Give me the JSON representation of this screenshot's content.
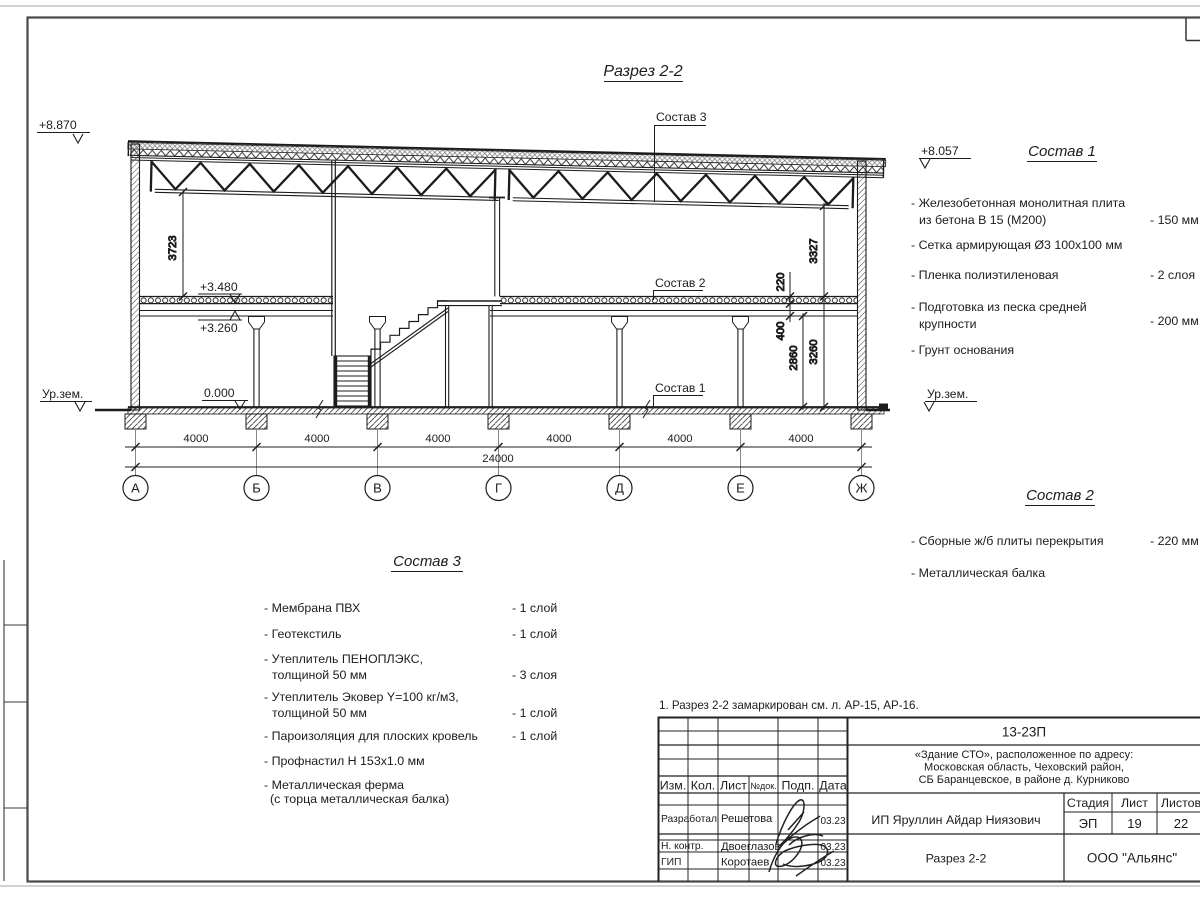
{
  "sheet": {
    "title": "Разрез 2-2",
    "note": "1. Разрез 2-2 замаркирован см. л. АР-15, АР-16."
  },
  "elevations": {
    "roof_left": "+8.870",
    "roof_right": "+8.057",
    "slab_top": "+3.480",
    "beam_bottom": "+3.260",
    "floor": "0.000",
    "ground_left": "Ур.зем.",
    "ground_right": "Ур.зем."
  },
  "dimensions": {
    "bay": "4000",
    "total": "24000",
    "v_left": "3723",
    "v_truss": "3327",
    "slab": "220",
    "d400": "400",
    "d2860": "2860",
    "d3260": "3260"
  },
  "axes": [
    "А",
    "Б",
    "В",
    "Г",
    "Д",
    "Е",
    "Ж"
  ],
  "callouts": {
    "s1": "Состав 1",
    "s2": "Состав 2",
    "s3": "Состав 3"
  },
  "sostav1": {
    "title": "Состав 1",
    "items": [
      {
        "l1": "- Железобетонная  монолитная плита",
        "l2": "из бетона В 15 (М200)",
        "val": "- 150 мм"
      },
      {
        "l1": "- Сетка армирующая Ø3 100х100 мм"
      },
      {
        "l1": "- Пленка полиэтиленовая",
        "val": "- 2 слоя"
      },
      {
        "l1": "- Подготовка из песка средней",
        "l2": "крупности",
        "val": "- 200 мм"
      },
      {
        "l1": "- Грунт основания"
      }
    ]
  },
  "sostav2": {
    "title": "Состав 2",
    "items": [
      {
        "l1": "- Сборные ж/б плиты перекрытия",
        "val": "- 220 мм"
      },
      {
        "l1": "- Металлическая  балка"
      }
    ]
  },
  "sostav3": {
    "title": "Состав 3",
    "items": [
      {
        "l1": "- Мембрана ПВХ",
        "val": "- 1 слой"
      },
      {
        "l1": "- Геотекстиль",
        "val": "- 1 слой"
      },
      {
        "l1": "- Утеплитель ПЕНОПЛЭКС,",
        "l2": "толщиной 50 мм",
        "val": "- 3 слоя"
      },
      {
        "l1": "- Утеплитель Эковер Y=100 кг/м3,",
        "l2": "толщиной 50 мм",
        "val": "- 1 слой"
      },
      {
        "l1": "- Пароизоляция для плоских кровель",
        "val": "- 1 слой"
      },
      {
        "l1": "- Профнастил Н 153х1.0 мм"
      },
      {
        "l1": "- Металлическая ферма",
        "l2": "(с торца металлическая балка)"
      }
    ]
  },
  "titleblock": {
    "doc_number": "13-23П",
    "object_line1": "«Здание СТО», расположенное по адресу:",
    "object_line2": "Московская область, Чеховский район,",
    "object_line3": "СБ Баранцевское, в районе д. Курниково",
    "col_izm": "Изм.",
    "col_kol": "Кол.",
    "col_list": "Лист",
    "col_ndok": "№док.",
    "col_podp": "Подп.",
    "col_data": "Дата",
    "row1_role": "Разработал",
    "row1_name": "Решетова",
    "row1_date": "03.23",
    "row2_role": "Н. контр.",
    "row2_name": "Двоеглазов",
    "row2_date": "03.23",
    "row3_role": "ГИП",
    "row3_name": "Коротаев",
    "row3_date": "03.23",
    "client": "ИП Яруллин Айдар Ниязович",
    "stage_label": "Стадия",
    "list_label": "Лист",
    "listov_label": "Листов",
    "stage": "ЭП",
    "list": "19",
    "listov": "22",
    "drawing_name": "Разрез 2-2",
    "company": "ООО \"Альянс\""
  },
  "colors": {
    "ink": "#1c1c1c",
    "frame": "#4a4a4a",
    "faint": "#c4c4c4"
  }
}
